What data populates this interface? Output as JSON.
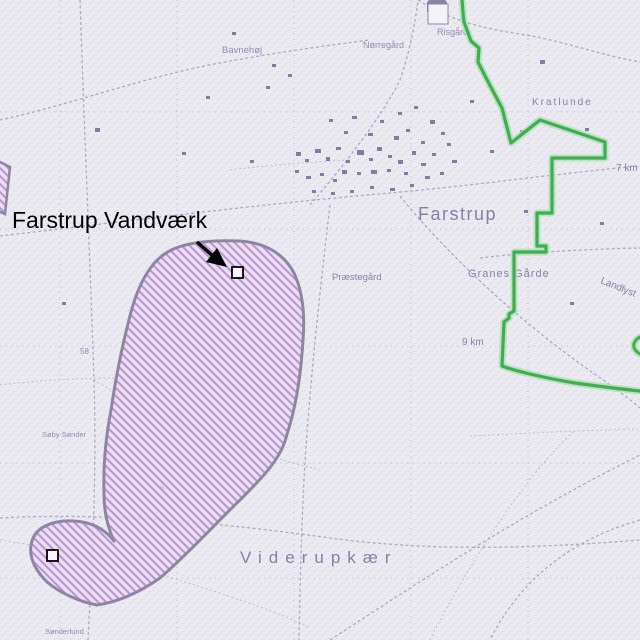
{
  "window": {
    "width": 640,
    "height": 640
  },
  "map": {
    "overlay_label": "Farstrup Vandværk",
    "labels": {
      "town": "Farstrup",
      "village": "Viderupkær",
      "granes_gaarde": "Granes Gårde",
      "praestegaard": "Præstegård",
      "bavnehoj": "Bavnehøj",
      "norregaard": "Nørregård",
      "risgaard": "Risgård",
      "kratlunde": "Kratlunde",
      "landlyst": "Landlyst",
      "soby_sonder": "Søby Sønder",
      "sonderlund": "Sønderlund",
      "elev_58": "58",
      "km9": "9 km",
      "km7": "7 km"
    },
    "colors": {
      "background": "#eceaf1",
      "speckle": "#c9c5db",
      "map_line": "#a29cc1",
      "map_text": "#867fa9",
      "building": "#77709c",
      "zone_fill": "#ecd9f2",
      "zone_hatch": "#ad87c9",
      "zone_border": "#8d85a2",
      "boundary_green": "#3fae4e",
      "boundary_halo": "#abdfb0",
      "overlay_text": "#000000",
      "marker_fill": "#f7f5fa",
      "marker_stroke": "#000000"
    },
    "markers": [
      {
        "name": "well-marker-north",
        "x": 232,
        "y": 267,
        "size": 11
      },
      {
        "name": "well-marker-south",
        "x": 47,
        "y": 550,
        "size": 11
      }
    ]
  }
}
